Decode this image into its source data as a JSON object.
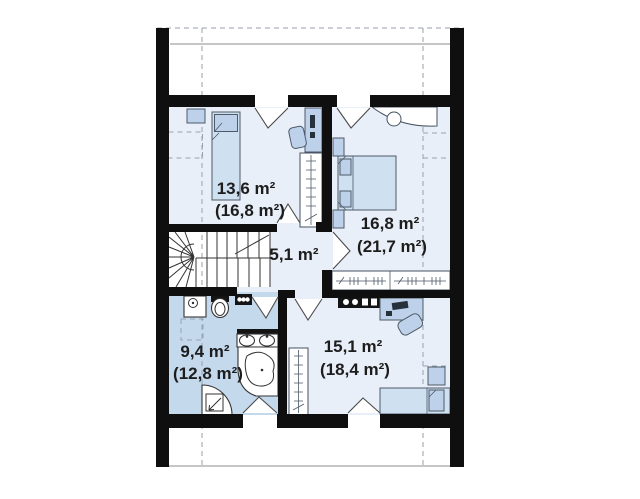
{
  "floor_plan": {
    "rooms": [
      {
        "name": "bedroom-top-left",
        "area": "13,6 m²",
        "gross_area": "(16,8 m²)"
      },
      {
        "name": "bedroom-right",
        "area": "16,8 m²",
        "gross_area": "(21,7 m²)"
      },
      {
        "name": "hallway",
        "area": "5,1 m²",
        "gross_area": ""
      },
      {
        "name": "bathroom",
        "area": "9,4 m²",
        "gross_area": "(12,8 m²)"
      },
      {
        "name": "room-bottom-right",
        "area": "15,1 m²",
        "gross_area": "(18,4 m²)"
      }
    ],
    "icons": [
      "staircase",
      "double-bed",
      "single-bed",
      "desk",
      "office-chair",
      "wardrobe",
      "washing-machine",
      "toilet",
      "double-sink",
      "corner-bathtub",
      "shower",
      "radiator",
      "door-swing",
      "roof-slope-dashed-line"
    ],
    "colors": {
      "wall": "#0f0f0f",
      "room_fill": "#e9eff8",
      "bathroom_fill": "#c5d9ed",
      "furniture_fill": "#bdd2ea",
      "label_text": "#1d1d1d"
    }
  }
}
